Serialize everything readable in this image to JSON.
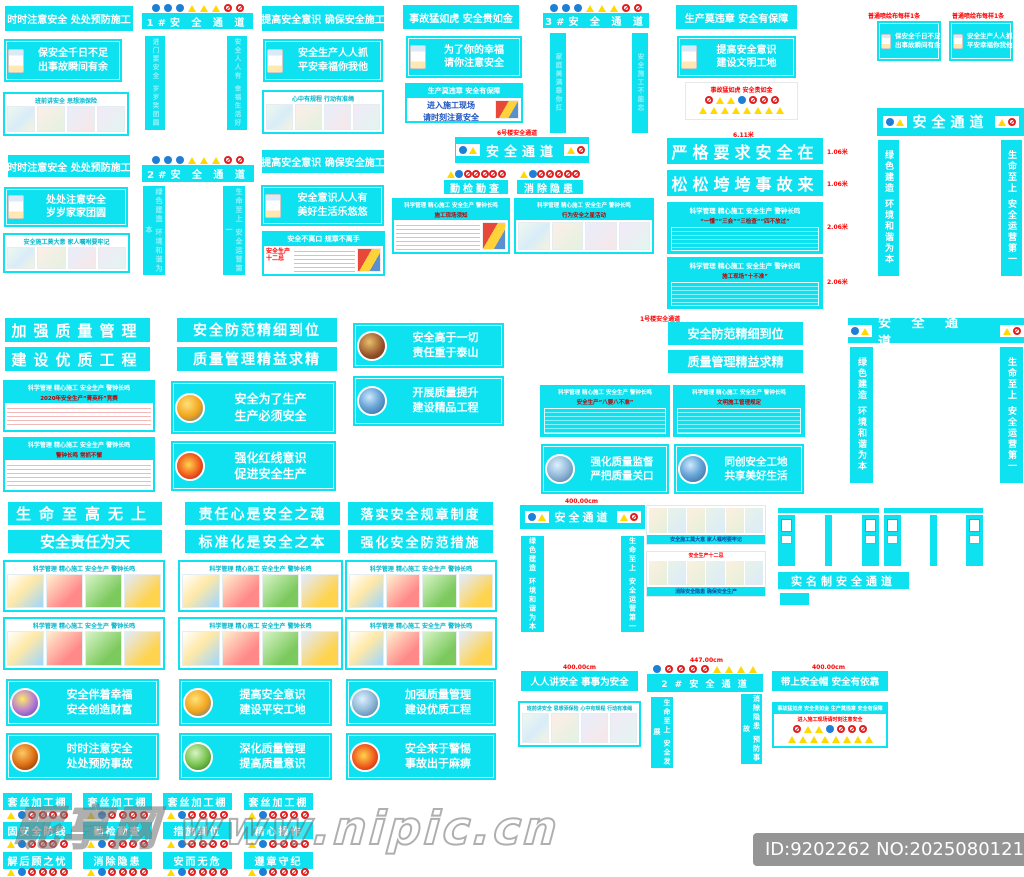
{
  "colors": {
    "banner_cyan": "#0ee1f0",
    "accent_red": "#ff0000",
    "text_white": "#ffffff",
    "title_teal": "#00b7cc",
    "mandatory_blue": "#1d7fd6",
    "warning_yellow": "#ffd900",
    "prohibition_red": "#e02020",
    "watermark_gray": "#8a8a8a"
  },
  "icons_legend": {
    "b": "mandatory-sign-icon",
    "w": "warning-sign-icon",
    "r": "prohibition-sign-icon"
  },
  "seq": {
    "numbered": "b,b,b,w,w,w,r,r",
    "pair_l": "b,w",
    "pair_r": "w,r",
    "strip7": "w,b,r,r,r,r,r",
    "beam_2b": "b,r,r,r,r,w,w,w,w",
    "grid_strip": "w,b,r,r,r,r",
    "ban_row": "r,w,w,b,r,r,r",
    "warn_row": "w,w,w,w,w,w,w,w"
  },
  "ptitle": "科学管理 精心施工 安全生产 警钟长鸣",
  "top": {
    "a1": "时时注意安全 处处预防施工",
    "b1": "提高安全意识 确保安全施工",
    "c1": "事故猛如虎 安全贵如金",
    "d1": "生产莫违章 安全有保障",
    "g1": "1#安 全 通 道",
    "g1l": "进门要安全 岁岁笑团圆",
    "g1r": "安全人人有 幸福生活好",
    "g3": "3#安 全 通 道",
    "g3l": "家庭美满靠你扛",
    "g3r": "安全施工不能忘",
    "a2a": "保安全千日不足",
    "a2b": "出事故瞬间有余",
    "b2a": "安全生产人人抓",
    "b2b": "平安幸福你我他",
    "c2a": "为了你的幸福",
    "c2b": "请你注意安全",
    "d2a": "提高安全意识",
    "d2b": "建设文明工地",
    "a3": "班前讲安全 思想添保险",
    "b3": "心中有规程 行动有准绳",
    "c3h": "生产莫违章 安全有保障",
    "c3a": "进入施工现场",
    "c3b": "请时刻注意安全",
    "d3": "事故猛如虎 安全贵如金",
    "note1": "普通喷绘布每样1条",
    "note2": "普通喷绘布每样1条",
    "tr1a": "保安全千日不足",
    "tr1b": "出事故瞬间有余",
    "tr2a": "安全生产人人抓",
    "tr2b": "平安幸福你我他"
  },
  "r2": {
    "e1": "时时注意安全 处处预防施工",
    "e2a": "处处注意安全",
    "e2b": "岁岁家家团圆",
    "e3": "安全施工莫大意 家人嘱咐要牢记",
    "g2": "2#安 全 通 道",
    "g2l": "绿色建造 环境和谐为本",
    "g2r": "生命至上 安全运营第一",
    "f1": "提高安全意识 确保安全施工",
    "f2a": "安全意识人人有",
    "f2b": "美好生活乐悠悠",
    "f3h": "安全不离口 规章不离手",
    "f3s": "安全生产十二忌",
    "gnote": "6号楼安全通道",
    "gbeam": "安全通道",
    "gb1": "勤检勤查",
    "gb2": "消除隐患",
    "gp1s": "施工现场须知",
    "gp2s": "行为安全之星活动",
    "hdim": "6.11米",
    "h1": "严格要求安全在",
    "h2": "松松垮垮事故来",
    "d106": "1.06米",
    "d206": "2.06米",
    "hp1s": "“一懂”“三会”“三检查”“四不放过”",
    "hp2s": "施工现场“十不准”",
    "r1beam": "安全通道",
    "r1l": "绿色建造 环境和谐为本",
    "r1r": "生命至上 安全运营第一"
  },
  "r3": {
    "i1": "加强质量管理",
    "i2": "建设优质工程",
    "ip1s": "2020年安全生产“菁英杯”竞赛",
    "ip2s": "警钟长鸣 常抓不懈",
    "j1": "安全防范精细到位",
    "j2": "质量管理精益求精",
    "j3a": "安全为了生产",
    "j3b": "生产必须安全",
    "j4a": "强化红线意识",
    "j4b": "促进安全生产",
    "k1a": "安全高于一切",
    "k1b": "责任重于泰山",
    "k2a": "开展质量提升",
    "k2b": "建设精品工程",
    "lnote": "1号楼安全通道",
    "l1": "安全防范精细到位",
    "l2": "质量管理精益求精",
    "lp1s": "安全生产“八要八不准”",
    "lp2s": "文明施工管理规定",
    "lf1a": "强化质量监督",
    "lf1b": "严把质量关口",
    "lf2a": "同创安全工地",
    "lf2b": "共享美好生活",
    "r2beam": "安 全 通 道",
    "r2l": "绿色建造 环境和谐为本",
    "r2r": "生命至上 安全运营第一"
  },
  "r4": {
    "m1": "生命至高无上",
    "m2": "安全责任为天",
    "n1": "责任心是安全之魂",
    "n2": "标准化是安全之本",
    "o1": "落实安全规章制度",
    "o2": "强化安全防范措施",
    "gn_dim": "400.00cm",
    "gnbeam": "安全通道",
    "gnl": "绿色建造 环境和谐为本",
    "gnr": "生命至上 安全运营第一",
    "info1": "安全施工莫大意 家人嘱咐要牢记",
    "info2": "消除安全隐患 确保安全生产",
    "info_tag": "安全生产十二忌",
    "realname": "实名制安全通道"
  },
  "r5": {
    "dimA": "400.00cm",
    "dimB": "447.00cm",
    "dimC": "400.00cm",
    "q1": "人人讲安全 事事为安全",
    "q1p": "班前讲安全 思想添保险  心中有规程 行动有准绳",
    "g2b": "2 # 安 全 通 道",
    "g2bl": "生命至上 安全发展",
    "g2br": "消除隐患 预防事故",
    "q2": "带上安全帽 安全有依靠",
    "q2p": "事故猛如虎 安全贵如金 生产莫违章 安全有保障",
    "q2ps": "进入施工现场请时刻注意安全",
    "w1a": "安全伴着幸福",
    "w1b": "安全创造财富",
    "w2a": "提高安全意识",
    "w2b": "建设平安工地",
    "w3a": "加强质量管理",
    "w3b": "建设优质工程",
    "w4a": "时时注意安全",
    "w4b": "处处预防事故",
    "w5a": "深化质量管理",
    "w5b": "提高质量意识",
    "w6a": "安全来于警惕",
    "w6b": "事故出于麻痹"
  },
  "grid": {
    "c11": "套丝加工棚",
    "c12": "套丝加工棚",
    "c13": "套丝加工棚",
    "c14": "套丝加工棚",
    "c21": "固安全防线",
    "c22": "勤检勤查",
    "c23": "措施到位",
    "c24": "精心操作",
    "c31": "解后顾之忧",
    "c32": "消除隐患",
    "c33": "安而无危",
    "c34": "遵章守纪"
  },
  "wm": {
    "site": "昵享网 www.nipic.cn",
    "id": "ID:9202262 NO:20250801211338076102"
  }
}
